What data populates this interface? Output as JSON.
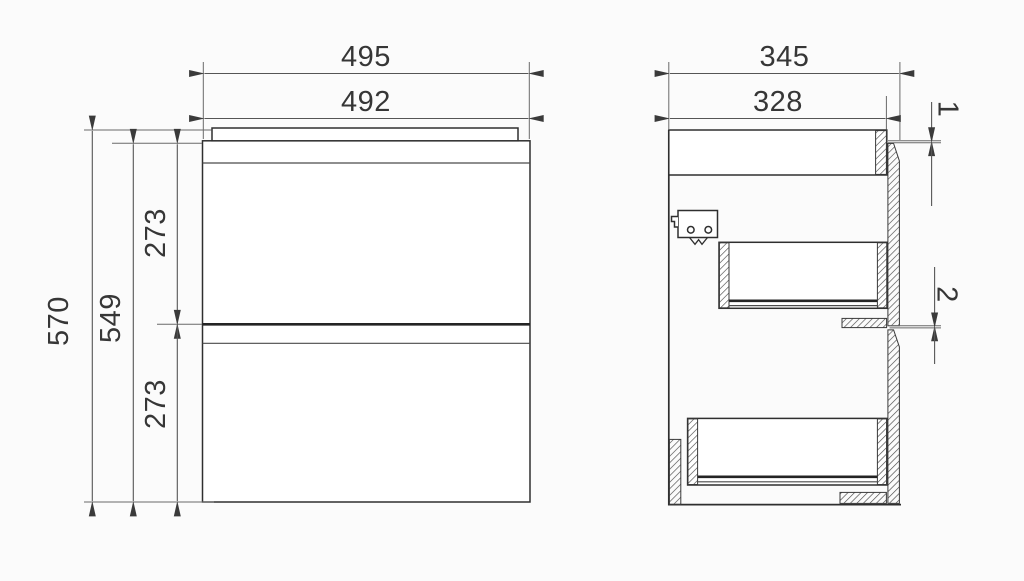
{
  "title": "Cabinet technical drawing - front and side section views",
  "colors": {
    "background": "#fbfbfb",
    "outline": "#2f2f2f",
    "dimension_line": "#555555",
    "hatch": "#4a4a4a",
    "text": "#363636"
  },
  "front_view": {
    "dims": {
      "overall_width": "495",
      "front_width": "492",
      "overall_height": "570",
      "carcass_height": "549",
      "upper_drawer_front_height": "273",
      "lower_drawer_front_height": "273"
    }
  },
  "side_view": {
    "dims": {
      "overall_depth": "345",
      "carcass_depth": "328",
      "top_reveal_gap": "1",
      "between_fronts_gap": "2"
    },
    "icons": {
      "soft_close_clip": "soft-close-clip-icon"
    }
  }
}
